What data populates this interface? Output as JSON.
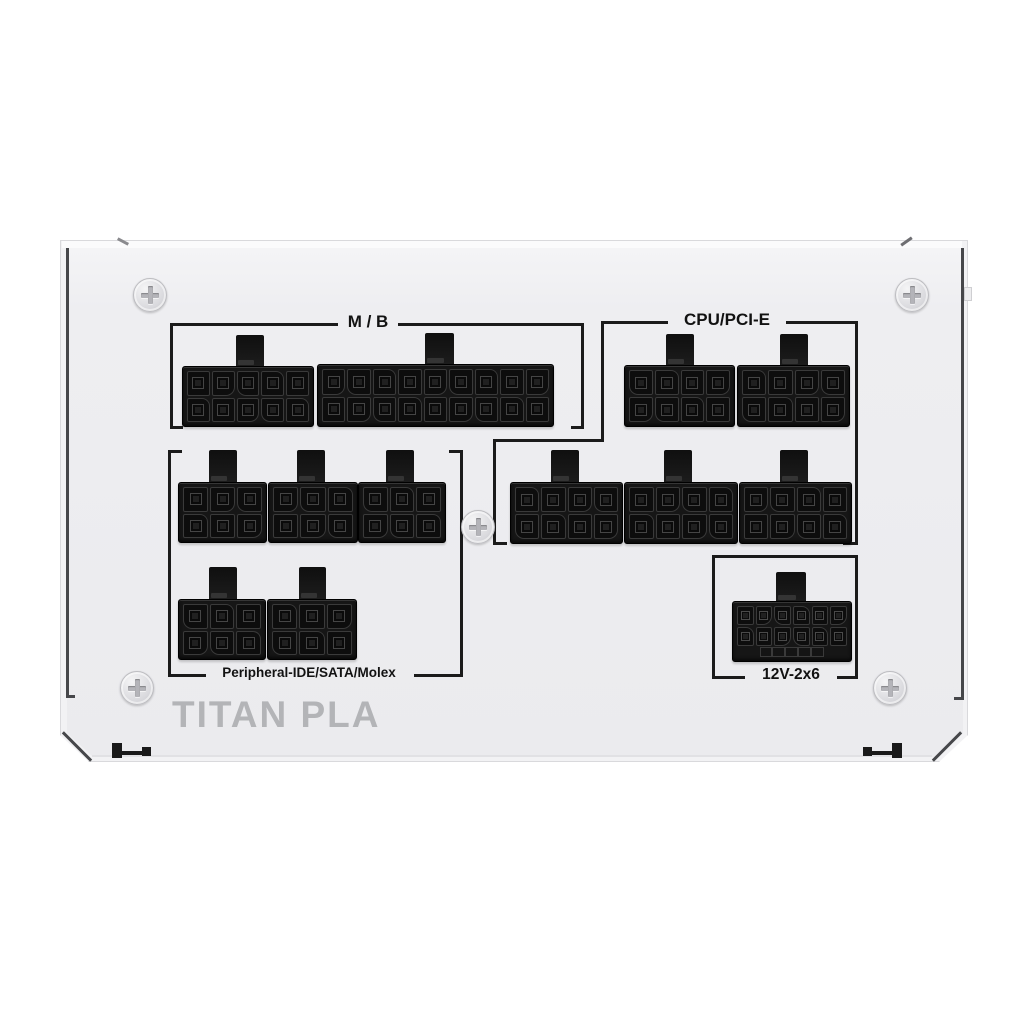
{
  "brand_text": "TITAN PLA",
  "groups": {
    "mb": {
      "label": "M / B",
      "ports": 2
    },
    "cpu_pcie": {
      "label": "CPU/PCI-E",
      "ports": 5
    },
    "peripheral": {
      "label": "Peripheral-IDE/SATA/Molex",
      "ports": 5
    },
    "v12": {
      "label": "12V-2x6",
      "ports": 1
    }
  },
  "connectors": [
    {
      "id": "mb_10",
      "group": "mb",
      "rows": 2,
      "cols": 5,
      "pins": "10-pin"
    },
    {
      "id": "mb_18",
      "group": "mb",
      "rows": 2,
      "cols": 9,
      "pins": "18-pin"
    },
    {
      "id": "cpu_a",
      "group": "cpu_pcie",
      "rows": 2,
      "cols": 4,
      "pins": "8-pin"
    },
    {
      "id": "cpu_b",
      "group": "cpu_pcie",
      "rows": 2,
      "cols": 4,
      "pins": "8-pin"
    },
    {
      "id": "per_m1",
      "group": "peripheral",
      "rows": 2,
      "cols": 3,
      "pins": "6-pin"
    },
    {
      "id": "per_m2",
      "group": "peripheral",
      "rows": 2,
      "cols": 3,
      "pins": "6-pin"
    },
    {
      "id": "per_m3",
      "group": "peripheral",
      "rows": 2,
      "cols": 3,
      "pins": "6-pin"
    },
    {
      "id": "cpu_m1",
      "group": "cpu_pcie",
      "rows": 2,
      "cols": 4,
      "pins": "8-pin"
    },
    {
      "id": "cpu_m2",
      "group": "cpu_pcie",
      "rows": 2,
      "cols": 4,
      "pins": "8-pin"
    },
    {
      "id": "cpu_m3",
      "group": "cpu_pcie",
      "rows": 2,
      "cols": 4,
      "pins": "8-pin"
    },
    {
      "id": "per_b1",
      "group": "peripheral",
      "rows": 2,
      "cols": 3,
      "pins": "6-pin"
    },
    {
      "id": "per_b2",
      "group": "peripheral",
      "rows": 2,
      "cols": 3,
      "pins": "6-pin"
    },
    {
      "id": "v12_1",
      "group": "v12",
      "rows": 2,
      "cols": 6,
      "pins": "12-pin",
      "sense_strip": true
    }
  ],
  "screw_count": 5,
  "colors": {
    "background": "#ffffff",
    "case_face": "#ededf0",
    "connector": "#151515",
    "bracket_line": "#1b1b1b",
    "label_text": "#121212",
    "brand_text": "#b3b4b7",
    "screw": "#d9dade"
  }
}
